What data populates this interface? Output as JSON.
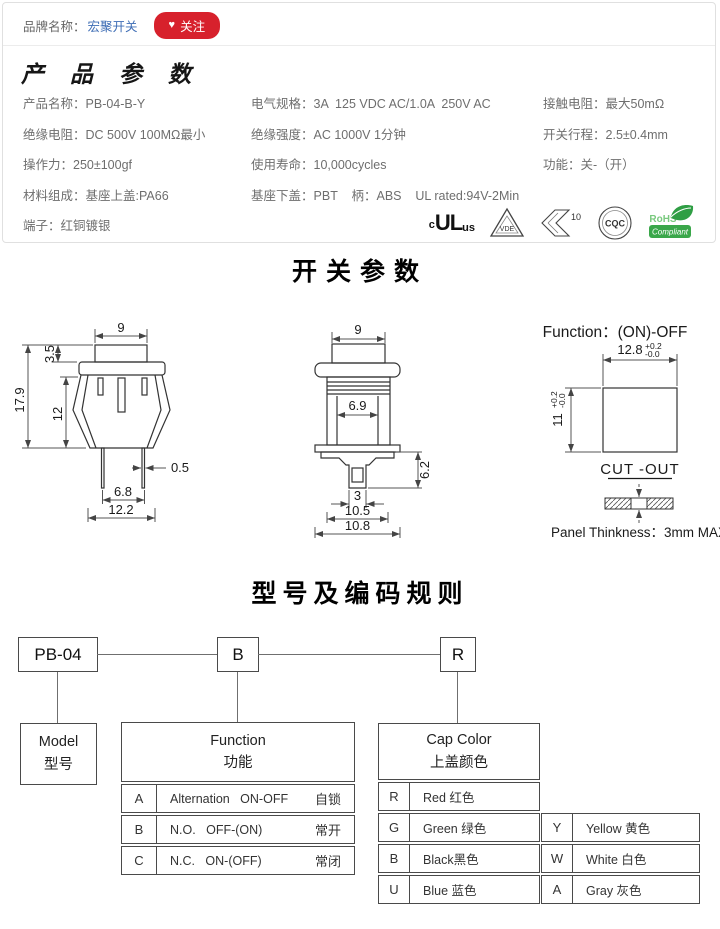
{
  "colors": {
    "brand_link": "#3e6db5",
    "follow_red": "#d7212c",
    "rohs_green": "#3aa74a"
  },
  "brand": {
    "label": "品牌名称：",
    "name": "宏聚开关",
    "heart": "♥",
    "follow": "关注"
  },
  "product": {
    "section_title": "产 品 参 数",
    "col1": [
      {
        "label": "产品名称：",
        "value": "PB-04-B-Y"
      },
      {
        "label": "绝缘电阻：",
        "value": "DC 500V 100MΩ最小"
      },
      {
        "label": "操作力：",
        "value": "250±100gf"
      },
      {
        "label": "材料组成：",
        "value": "基座上盖:PA66"
      },
      {
        "label": "端子：",
        "value": "红铜镀银"
      }
    ],
    "col2": [
      {
        "label": "电气规格：",
        "value": "3A  125 VDC AC/1.0A  250V AC"
      },
      {
        "label": "绝缘强度：",
        "value": "AC 1000V 1分钟"
      },
      {
        "label": "使用寿命：",
        "value": "10,000cycles"
      },
      {
        "label": "基座下盖：",
        "value": "PBT    柄：ABS    UL rated:94V-2Min"
      }
    ],
    "col3": [
      {
        "label": "接触电阻：",
        "value": "最大50mΩ"
      },
      {
        "label": "开关行程：",
        "value": "2.5±0.4mm"
      },
      {
        "label": "功能：",
        "value": "关-（开）"
      }
    ]
  },
  "certs": {
    "ul_c": "c",
    "ul": "UL",
    "ul_us": "us",
    "vde": "VDE",
    "k10": "10",
    "cqc": "CQC",
    "rohs": "RoHS",
    "rohs2": "Compliant"
  },
  "switch_section": {
    "title": "开关参数",
    "front": {
      "w_top": "9",
      "h_btn": "3.5",
      "h_total": "17.9",
      "h_body": "12",
      "pin_w": "0.5",
      "pin_pitch": "6.8",
      "base_w": "12.2"
    },
    "side": {
      "w_top": "9",
      "w_inner": "6.9",
      "h_lower": "6.2",
      "w_slot": "3",
      "w_mid": "10.5",
      "w_base": "10.8"
    },
    "cutout": {
      "function": "Function：(ON)-OFF",
      "w": "12.8",
      "w_tol_up": "+0.2",
      "w_tol_dn": "-0.0",
      "h": "11",
      "h_tol_up": "+0.2",
      "h_tol_dn": "-0.0",
      "label": "CUT -OUT",
      "panel": "Panel Thinkness：3mm MAX"
    }
  },
  "coding": {
    "title": "型号及编码规则",
    "model_code": "PB-04",
    "func_code": "B",
    "color_code": "R",
    "model": {
      "en": "Model",
      "zh": "型号"
    },
    "function": {
      "en": "Function",
      "zh": "功能",
      "rows": [
        {
          "code": "A",
          "desc": "Alternation   ON-OFF",
          "zh": "自锁"
        },
        {
          "code": "B",
          "desc": "N.O.   OFF-(ON)",
          "zh": "常开"
        },
        {
          "code": "C",
          "desc": "N.C.   ON-(OFF)",
          "zh": "常闭"
        }
      ]
    },
    "cap": {
      "en": "Cap Color",
      "zh": "上盖颜色",
      "left": [
        {
          "code": "R",
          "desc": "Red 红色"
        },
        {
          "code": "G",
          "desc": "Green 绿色"
        },
        {
          "code": "B",
          "desc": "Black黑色"
        },
        {
          "code": "U",
          "desc": "Blue 蓝色"
        }
      ],
      "right": [
        {
          "code": "Y",
          "desc": "Yellow 黄色"
        },
        {
          "code": "W",
          "desc": "White 白色"
        },
        {
          "code": "A",
          "desc": "Gray 灰色"
        }
      ]
    }
  }
}
